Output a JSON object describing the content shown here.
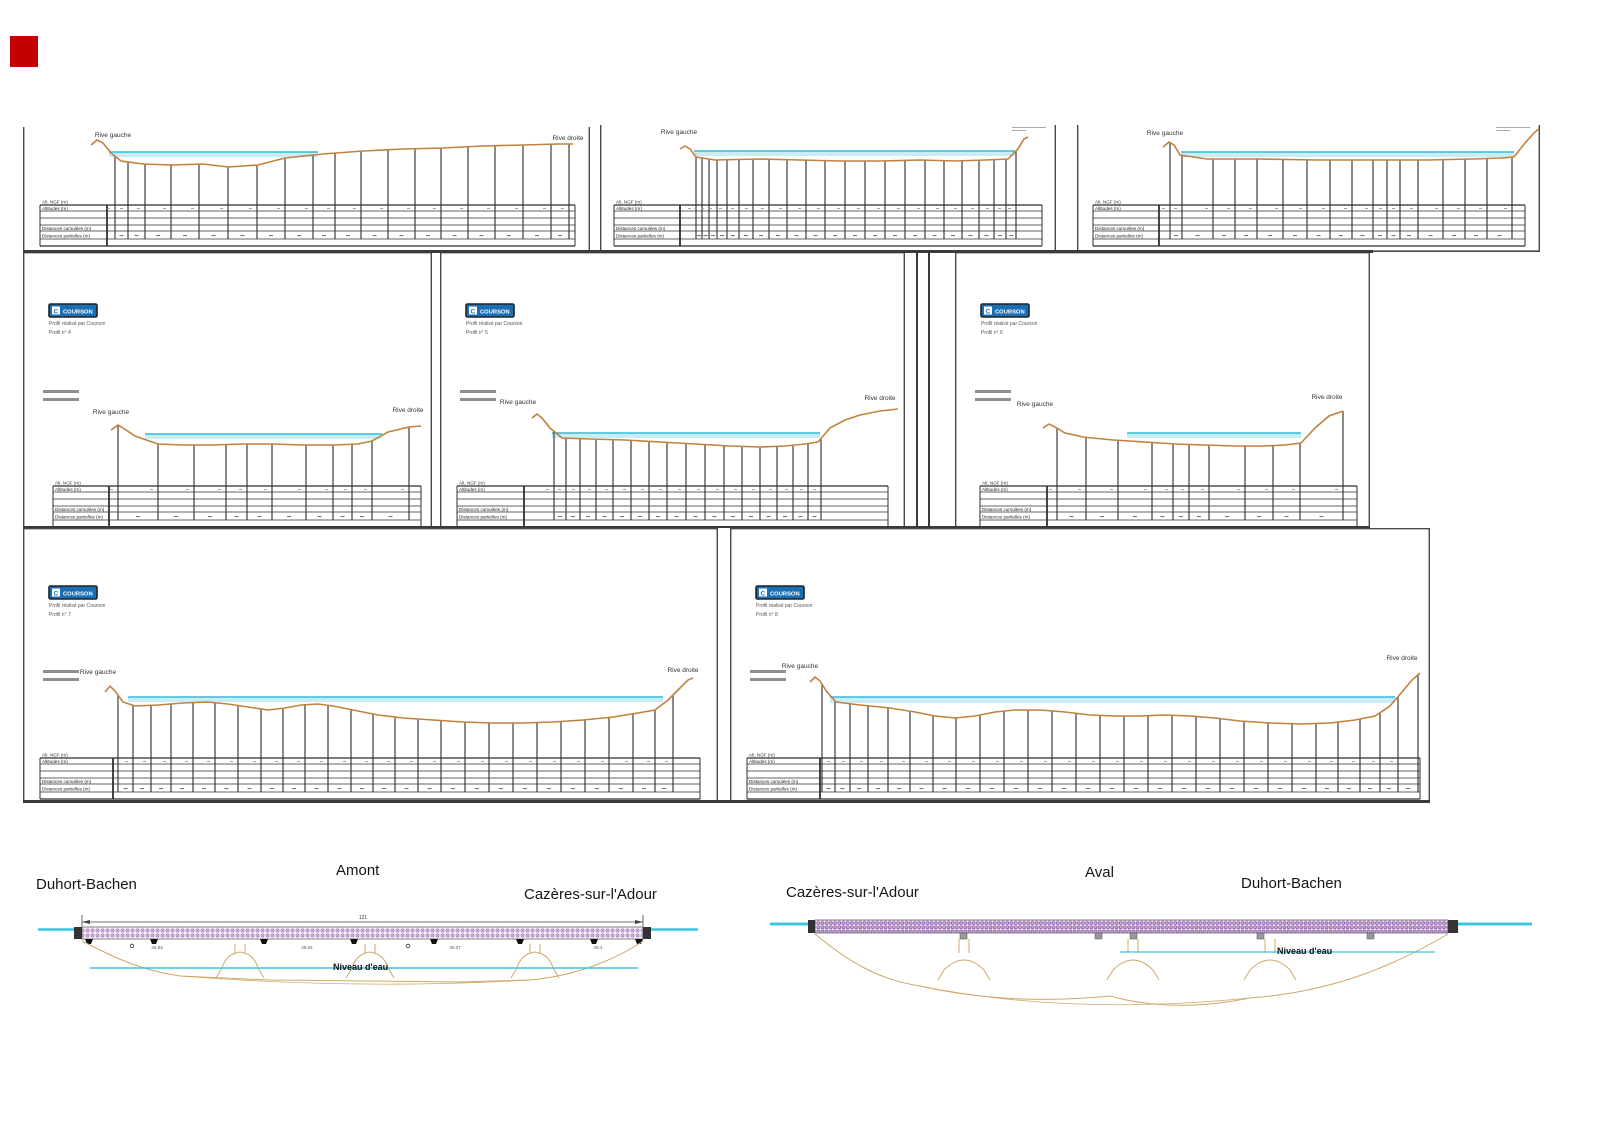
{
  "page": {
    "background": "#ffffff",
    "marker_color": "#c40000"
  },
  "branding": {
    "logo_text": "COURSON",
    "logo_bg": "#1a6fb4",
    "caption_line1": "Profil réalisé par Courson"
  },
  "labels": {
    "bank_left": "Rive gauche",
    "bank_right": "Rive droite",
    "table_corner": "Alt. NGF (m)",
    "table_rows": [
      "Altitudes (m)",
      "Distances cumulées (m)",
      "Distances partielles (m)"
    ]
  },
  "colors": {
    "terrain": "#c0823e",
    "water_fill": "#c9ecf5",
    "water_edge": "#35bcd8",
    "vertical": "#4a4a4a",
    "table_line": "#2f2f2f",
    "border": "#4a4a4a",
    "legend_bar": "#8f8f8f",
    "deck_upstream": "#a678bc",
    "deck_downstream": "#8f5fae",
    "cyan": "#3ec6dc",
    "pier_tan": "#cfa86a",
    "dim_line": "#444444",
    "text_dark": "#1c1c1c",
    "tiny_text": "#555555"
  },
  "panels": [
    {
      "name": "profile-sheet-1",
      "box": [
        23,
        127,
        567,
        125
      ],
      "cut_top": true,
      "header": false,
      "corner_mark": false,
      "num": "",
      "bank_left_pos": [
        90,
        10
      ],
      "bank_right_pos": [
        545,
        13
      ],
      "terrain": [
        [
          68,
          18
        ],
        [
          74,
          13
        ],
        [
          80,
          16
        ],
        [
          88,
          26
        ],
        [
          98,
          34
        ],
        [
          120,
          37
        ],
        [
          150,
          38
        ],
        [
          180,
          37
        ],
        [
          205,
          40
        ],
        [
          235,
          38
        ],
        [
          262,
          31
        ],
        [
          300,
          27
        ],
        [
          340,
          24
        ],
        [
          380,
          22
        ],
        [
          420,
          21
        ],
        [
          460,
          19
        ],
        [
          500,
          18
        ],
        [
          535,
          17
        ],
        [
          550,
          17
        ]
      ],
      "water": [
        86,
        295,
        25,
        5
      ],
      "verticals": [
        92,
        105,
        122,
        148,
        176,
        205,
        234,
        262,
        290,
        312,
        338,
        365,
        392,
        418,
        445,
        472,
        500,
        528,
        546
      ],
      "table": {
        "left": 17,
        "col": 84,
        "right": 552,
        "top": 78
      }
    },
    {
      "name": "profile-sheet-2",
      "box": [
        600,
        125,
        456,
        127
      ],
      "cut_top": true,
      "header": false,
      "corner_mark": true,
      "num": "",
      "bank_left_pos": [
        79,
        9
      ],
      "bank_right_pos": null,
      "terrain": [
        [
          80,
          24
        ],
        [
          85,
          21
        ],
        [
          90,
          24
        ],
        [
          96,
          32
        ],
        [
          115,
          35
        ],
        [
          160,
          34
        ],
        [
          200,
          35
        ],
        [
          240,
          36
        ],
        [
          280,
          36
        ],
        [
          320,
          35
        ],
        [
          355,
          36
        ],
        [
          385,
          35
        ],
        [
          408,
          34
        ],
        [
          418,
          24
        ],
        [
          424,
          14
        ],
        [
          428,
          12
        ]
      ],
      "water": [
        94,
        415,
        26,
        5
      ],
      "verticals": [
        96,
        102,
        109,
        117,
        127,
        139,
        153,
        169,
        187,
        206,
        225,
        245,
        265,
        285,
        305,
        325,
        344,
        362,
        379,
        394,
        406,
        416
      ],
      "table": {
        "left": 14,
        "col": 80,
        "right": 442,
        "top": 80
      }
    },
    {
      "name": "profile-sheet-3",
      "box": [
        1077,
        125,
        463,
        127
      ],
      "cut_top": true,
      "header": false,
      "corner_mark": true,
      "num": "",
      "bank_left_pos": [
        88,
        10
      ],
      "bank_right_pos": null,
      "terrain": [
        [
          86,
          22
        ],
        [
          92,
          17
        ],
        [
          97,
          20
        ],
        [
          103,
          30
        ],
        [
          130,
          34
        ],
        [
          180,
          34
        ],
        [
          240,
          35
        ],
        [
          300,
          35
        ],
        [
          350,
          35
        ],
        [
          395,
          34
        ],
        [
          425,
          33
        ],
        [
          437,
          32
        ],
        [
          448,
          18
        ],
        [
          458,
          7
        ],
        [
          462,
          4
        ]
      ],
      "water": [
        104,
        437,
        27,
        5
      ],
      "verticals": [
        93,
        105,
        136,
        158,
        180,
        206,
        230,
        253,
        275,
        296,
        310,
        323,
        341,
        366,
        388,
        410,
        435
      ],
      "table": {
        "left": 16,
        "col": 82,
        "right": 448,
        "top": 80
      }
    },
    {
      "name": "profile-sheet-4",
      "box": [
        23,
        252,
        409,
        276
      ],
      "cut_top": false,
      "header": true,
      "corner_mark": false,
      "num": "Profil n° 4",
      "bank_left_pos": [
        88,
        162
      ],
      "bank_right_pos": [
        385,
        160
      ],
      "terrain": [
        [
          88,
          178
        ],
        [
          95,
          173
        ],
        [
          100,
          176
        ],
        [
          112,
          184
        ],
        [
          135,
          192
        ],
        [
          160,
          193
        ],
        [
          190,
          193
        ],
        [
          220,
          192
        ],
        [
          250,
          192
        ],
        [
          280,
          193
        ],
        [
          310,
          193
        ],
        [
          335,
          192
        ],
        [
          349,
          189
        ],
        [
          365,
          180
        ],
        [
          386,
          175
        ],
        [
          398,
          174
        ]
      ],
      "water": [
        122,
        359,
        182,
        5
      ],
      "verticals": [
        95,
        135,
        171,
        203,
        224,
        249,
        283,
        310,
        329,
        349,
        386
      ],
      "table": {
        "left": 30,
        "col": 86,
        "right": 398,
        "top": 234
      }
    },
    {
      "name": "profile-sheet-5",
      "box": [
        440,
        252,
        465,
        276
      ],
      "cut_top": false,
      "header": true,
      "corner_mark": false,
      "num": "Profil n° 5",
      "bank_left_pos": [
        78,
        152
      ],
      "bank_right_pos": [
        440,
        148
      ],
      "terrain": [
        [
          92,
          166
        ],
        [
          97,
          162
        ],
        [
          102,
          166
        ],
        [
          110,
          176
        ],
        [
          122,
          186
        ],
        [
          150,
          187
        ],
        [
          185,
          188
        ],
        [
          220,
          190
        ],
        [
          255,
          192
        ],
        [
          290,
          194
        ],
        [
          320,
          195
        ],
        [
          345,
          194
        ],
        [
          365,
          192
        ],
        [
          378,
          190
        ],
        [
          390,
          176
        ],
        [
          405,
          168
        ],
        [
          420,
          163
        ],
        [
          440,
          159
        ],
        [
          458,
          157
        ]
      ],
      "water": [
        112,
        380,
        181,
        5
      ],
      "verticals": [
        114,
        126,
        140,
        156,
        173,
        191,
        209,
        227,
        246,
        265,
        284,
        302,
        320,
        337,
        353,
        368,
        381
      ],
      "table": {
        "left": 17,
        "col": 84,
        "right": 448,
        "top": 234
      }
    },
    {
      "name": "profile-sheet-6",
      "box": [
        955,
        252,
        415,
        276
      ],
      "cut_top": false,
      "header": true,
      "corner_mark": false,
      "num": "Profil n° 6",
      "bank_left_pos": [
        80,
        154
      ],
      "bank_right_pos": [
        372,
        147
      ],
      "terrain": [
        [
          88,
          176
        ],
        [
          94,
          172
        ],
        [
          100,
          175
        ],
        [
          110,
          181
        ],
        [
          128,
          185
        ],
        [
          158,
          188
        ],
        [
          190,
          190
        ],
        [
          220,
          192
        ],
        [
          250,
          193
        ],
        [
          280,
          194
        ],
        [
          310,
          194
        ],
        [
          330,
          193
        ],
        [
          346,
          191
        ],
        [
          360,
          176
        ],
        [
          374,
          164
        ],
        [
          388,
          159
        ]
      ],
      "water": [
        172,
        346,
        181,
        5
      ],
      "verticals": [
        102,
        131,
        163,
        197,
        218,
        234,
        254,
        290,
        318,
        345,
        388
      ],
      "table": {
        "left": 25,
        "col": 92,
        "right": 402,
        "top": 234
      }
    },
    {
      "name": "profile-sheet-7",
      "box": [
        23,
        528,
        695,
        274
      ],
      "cut_top": false,
      "header": true,
      "corner_mark": false,
      "num": "Profil n° 7",
      "bank_left_pos": [
        75,
        146
      ],
      "bank_right_pos": [
        660,
        144
      ],
      "terrain": [
        [
          82,
          164
        ],
        [
          87,
          158
        ],
        [
          92,
          163
        ],
        [
          100,
          174
        ],
        [
          112,
          178
        ],
        [
          135,
          177
        ],
        [
          160,
          175
        ],
        [
          185,
          174
        ],
        [
          205,
          176
        ],
        [
          225,
          179
        ],
        [
          245,
          182
        ],
        [
          262,
          180
        ],
        [
          278,
          177
        ],
        [
          295,
          176
        ],
        [
          310,
          178
        ],
        [
          330,
          182
        ],
        [
          355,
          187
        ],
        [
          380,
          190
        ],
        [
          410,
          192
        ],
        [
          440,
          194
        ],
        [
          470,
          195
        ],
        [
          500,
          195
        ],
        [
          530,
          194
        ],
        [
          560,
          192
        ],
        [
          590,
          189
        ],
        [
          615,
          185
        ],
        [
          632,
          182
        ],
        [
          645,
          172
        ],
        [
          655,
          162
        ],
        [
          665,
          152
        ],
        [
          670,
          150
        ]
      ],
      "water": [
        105,
        640,
        169,
        5
      ],
      "verticals": [
        95,
        110,
        128,
        148,
        170,
        192,
        215,
        238,
        260,
        282,
        305,
        328,
        350,
        372,
        395,
        418,
        442,
        466,
        490,
        514,
        538,
        562,
        586,
        610,
        632,
        650
      ],
      "table": {
        "left": 17,
        "col": 90,
        "right": 677,
        "top": 230
      }
    },
    {
      "name": "profile-sheet-8",
      "box": [
        730,
        528,
        700,
        274
      ],
      "cut_top": false,
      "header": true,
      "corner_mark": false,
      "num": "Profil n° 8",
      "bank_left_pos": [
        70,
        140
      ],
      "bank_right_pos": [
        672,
        132
      ],
      "terrain": [
        [
          80,
          154
        ],
        [
          85,
          149
        ],
        [
          90,
          153
        ],
        [
          97,
          164
        ],
        [
          106,
          174
        ],
        [
          130,
          177
        ],
        [
          160,
          180
        ],
        [
          185,
          184
        ],
        [
          205,
          188
        ],
        [
          225,
          190
        ],
        [
          245,
          188
        ],
        [
          265,
          184
        ],
        [
          285,
          182
        ],
        [
          310,
          182
        ],
        [
          335,
          184
        ],
        [
          360,
          187
        ],
        [
          385,
          188
        ],
        [
          410,
          188
        ],
        [
          435,
          187
        ],
        [
          460,
          188
        ],
        [
          485,
          190
        ],
        [
          510,
          193
        ],
        [
          540,
          195
        ],
        [
          570,
          196
        ],
        [
          600,
          195
        ],
        [
          625,
          192
        ],
        [
          645,
          188
        ],
        [
          660,
          178
        ],
        [
          672,
          164
        ],
        [
          682,
          152
        ],
        [
          690,
          145
        ]
      ],
      "water": [
        100,
        665,
        169,
        6
      ],
      "verticals": [
        92,
        105,
        120,
        138,
        158,
        180,
        203,
        226,
        250,
        274,
        298,
        322,
        346,
        370,
        394,
        418,
        442,
        466,
        490,
        514,
        538,
        562,
        586,
        608,
        630,
        650,
        668,
        688
      ],
      "table": {
        "left": 17,
        "col": 90,
        "right": 690,
        "top": 230
      }
    }
  ],
  "separators": [
    {
      "x": 23,
      "y": 250,
      "w": 1350,
      "h": 3
    },
    {
      "x": 916,
      "y": 252,
      "w": 2,
      "h": 276
    },
    {
      "x": 928,
      "y": 252,
      "w": 2,
      "h": 276
    },
    {
      "x": 23,
      "y": 526,
      "w": 1347,
      "h": 2
    },
    {
      "x": 23,
      "y": 800,
      "w": 1407,
      "h": 3
    }
  ],
  "elevations": {
    "upstream": {
      "city_left": "Duhort-Bachen",
      "center_label": "Amont",
      "city_right": "Cazères-sur-l'Adour",
      "total_dim": "121",
      "span_dims": [
        "33.93",
        "29.04",
        "30.07",
        "29.4"
      ],
      "water_label": "Niveau d'eau"
    },
    "downstream": {
      "city_left": "Cazères-sur-l'Adour",
      "center_label": "Aval",
      "city_right": "Duhort-Bachen",
      "water_label": "Niveau d'eau"
    }
  }
}
